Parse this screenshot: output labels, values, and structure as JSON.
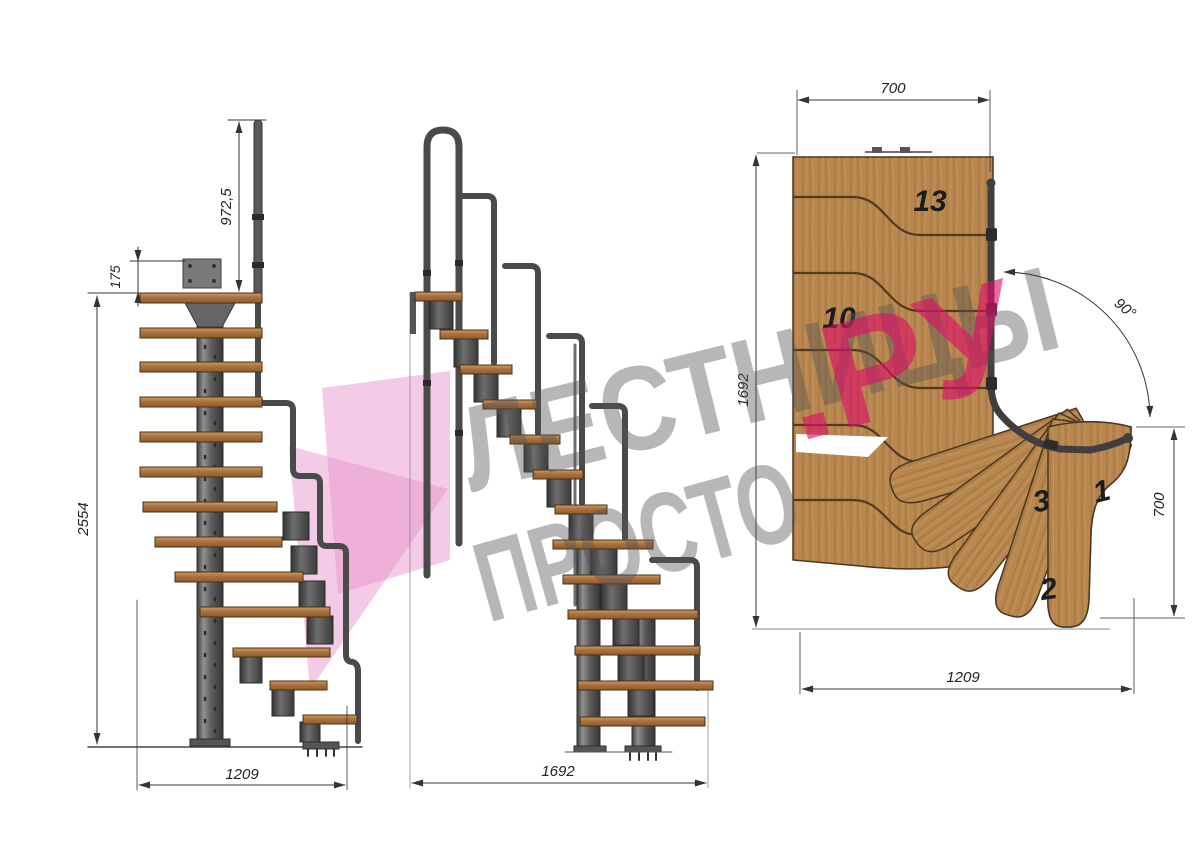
{
  "title": "Modular 90-degree staircase technical drawing",
  "watermark": {
    "line1": "ЛЕСТНИЦЫ",
    "line2_gray": "ПРОСТО",
    "line2_pink": ".РУ"
  },
  "side_view": {
    "dim_rail_height": "972,5",
    "dim_top_step": "175",
    "dim_total_height": "2554",
    "dim_width": "1209"
  },
  "front_view": {
    "dim_width": "1692"
  },
  "plan_view": {
    "dim_top_width": "700",
    "dim_left_depth": "1692",
    "dim_turn_angle": "90°",
    "dim_right_width": "700",
    "dim_bottom_length": "1209",
    "step_labels": {
      "top": "13",
      "middle": "10",
      "turn_third": "3",
      "turn_first": "1",
      "turn_second": "2"
    }
  },
  "colors": {
    "wood": "#b8874f",
    "wood_line": "#4a3620",
    "tread": "#aa713d",
    "steel": "#585858",
    "rail": "#474747",
    "dim_line": "#333333",
    "watermark_gray": "#555555",
    "watermark_pink": "#dd1068",
    "logo_pink": "#e78dc9"
  }
}
